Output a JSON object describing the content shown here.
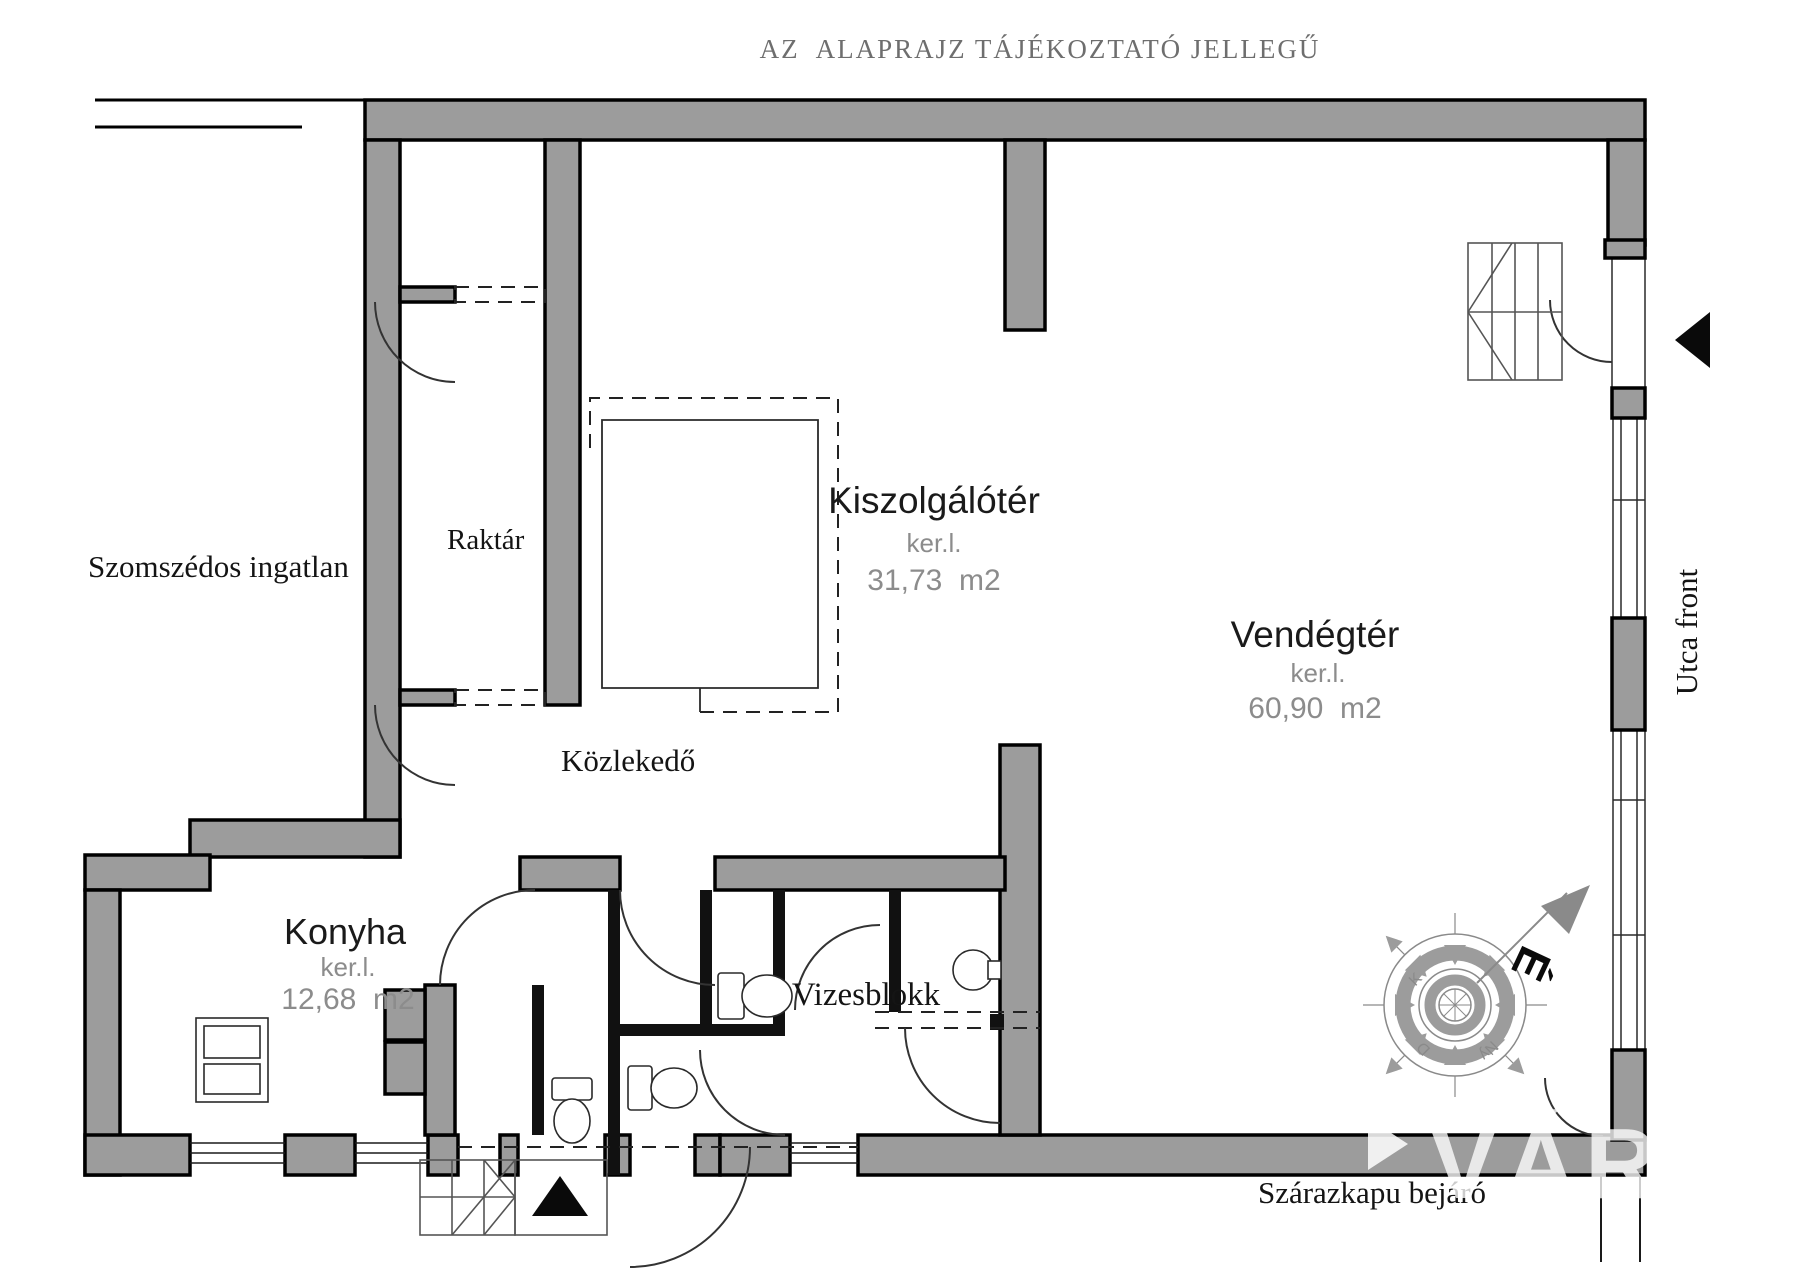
{
  "page": {
    "disclaimer": "AZ  ALAPRAJZ TÁJÉKOZTATÓ JELLEGŰ"
  },
  "colors": {
    "wall_fill": "#9c9c9c",
    "outline": "#000000",
    "muted_text": "#8c8c8c",
    "title_text": "#6e6e6e",
    "watermark": "#ffffff"
  },
  "rooms": {
    "raktar": {
      "name": "Raktár"
    },
    "kiszolgaloter": {
      "name": "Kiszolgálótér",
      "unit": "ker.l.",
      "area": "31,73  m2"
    },
    "vendegter": {
      "name": "Vendégtér",
      "unit": "ker.l.",
      "area": "60,90  m2"
    },
    "kozlekedo": {
      "name": "Közlekedő"
    },
    "konyha": {
      "name": "Konyha",
      "unit": "ker.l.",
      "area": "12,68  m2"
    },
    "vizesblokk": {
      "name": "Vizesblokk"
    }
  },
  "annotations": {
    "neighbor": "Szomszédos ingatlan",
    "street_front": "Utca front",
    "gate_entrance": "Szárazkapu bejáró"
  },
  "compass": {
    "north": "É",
    "east": "K",
    "south": "D",
    "west": "Ny"
  },
  "watermark": {
    "text": "VÁRO"
  }
}
